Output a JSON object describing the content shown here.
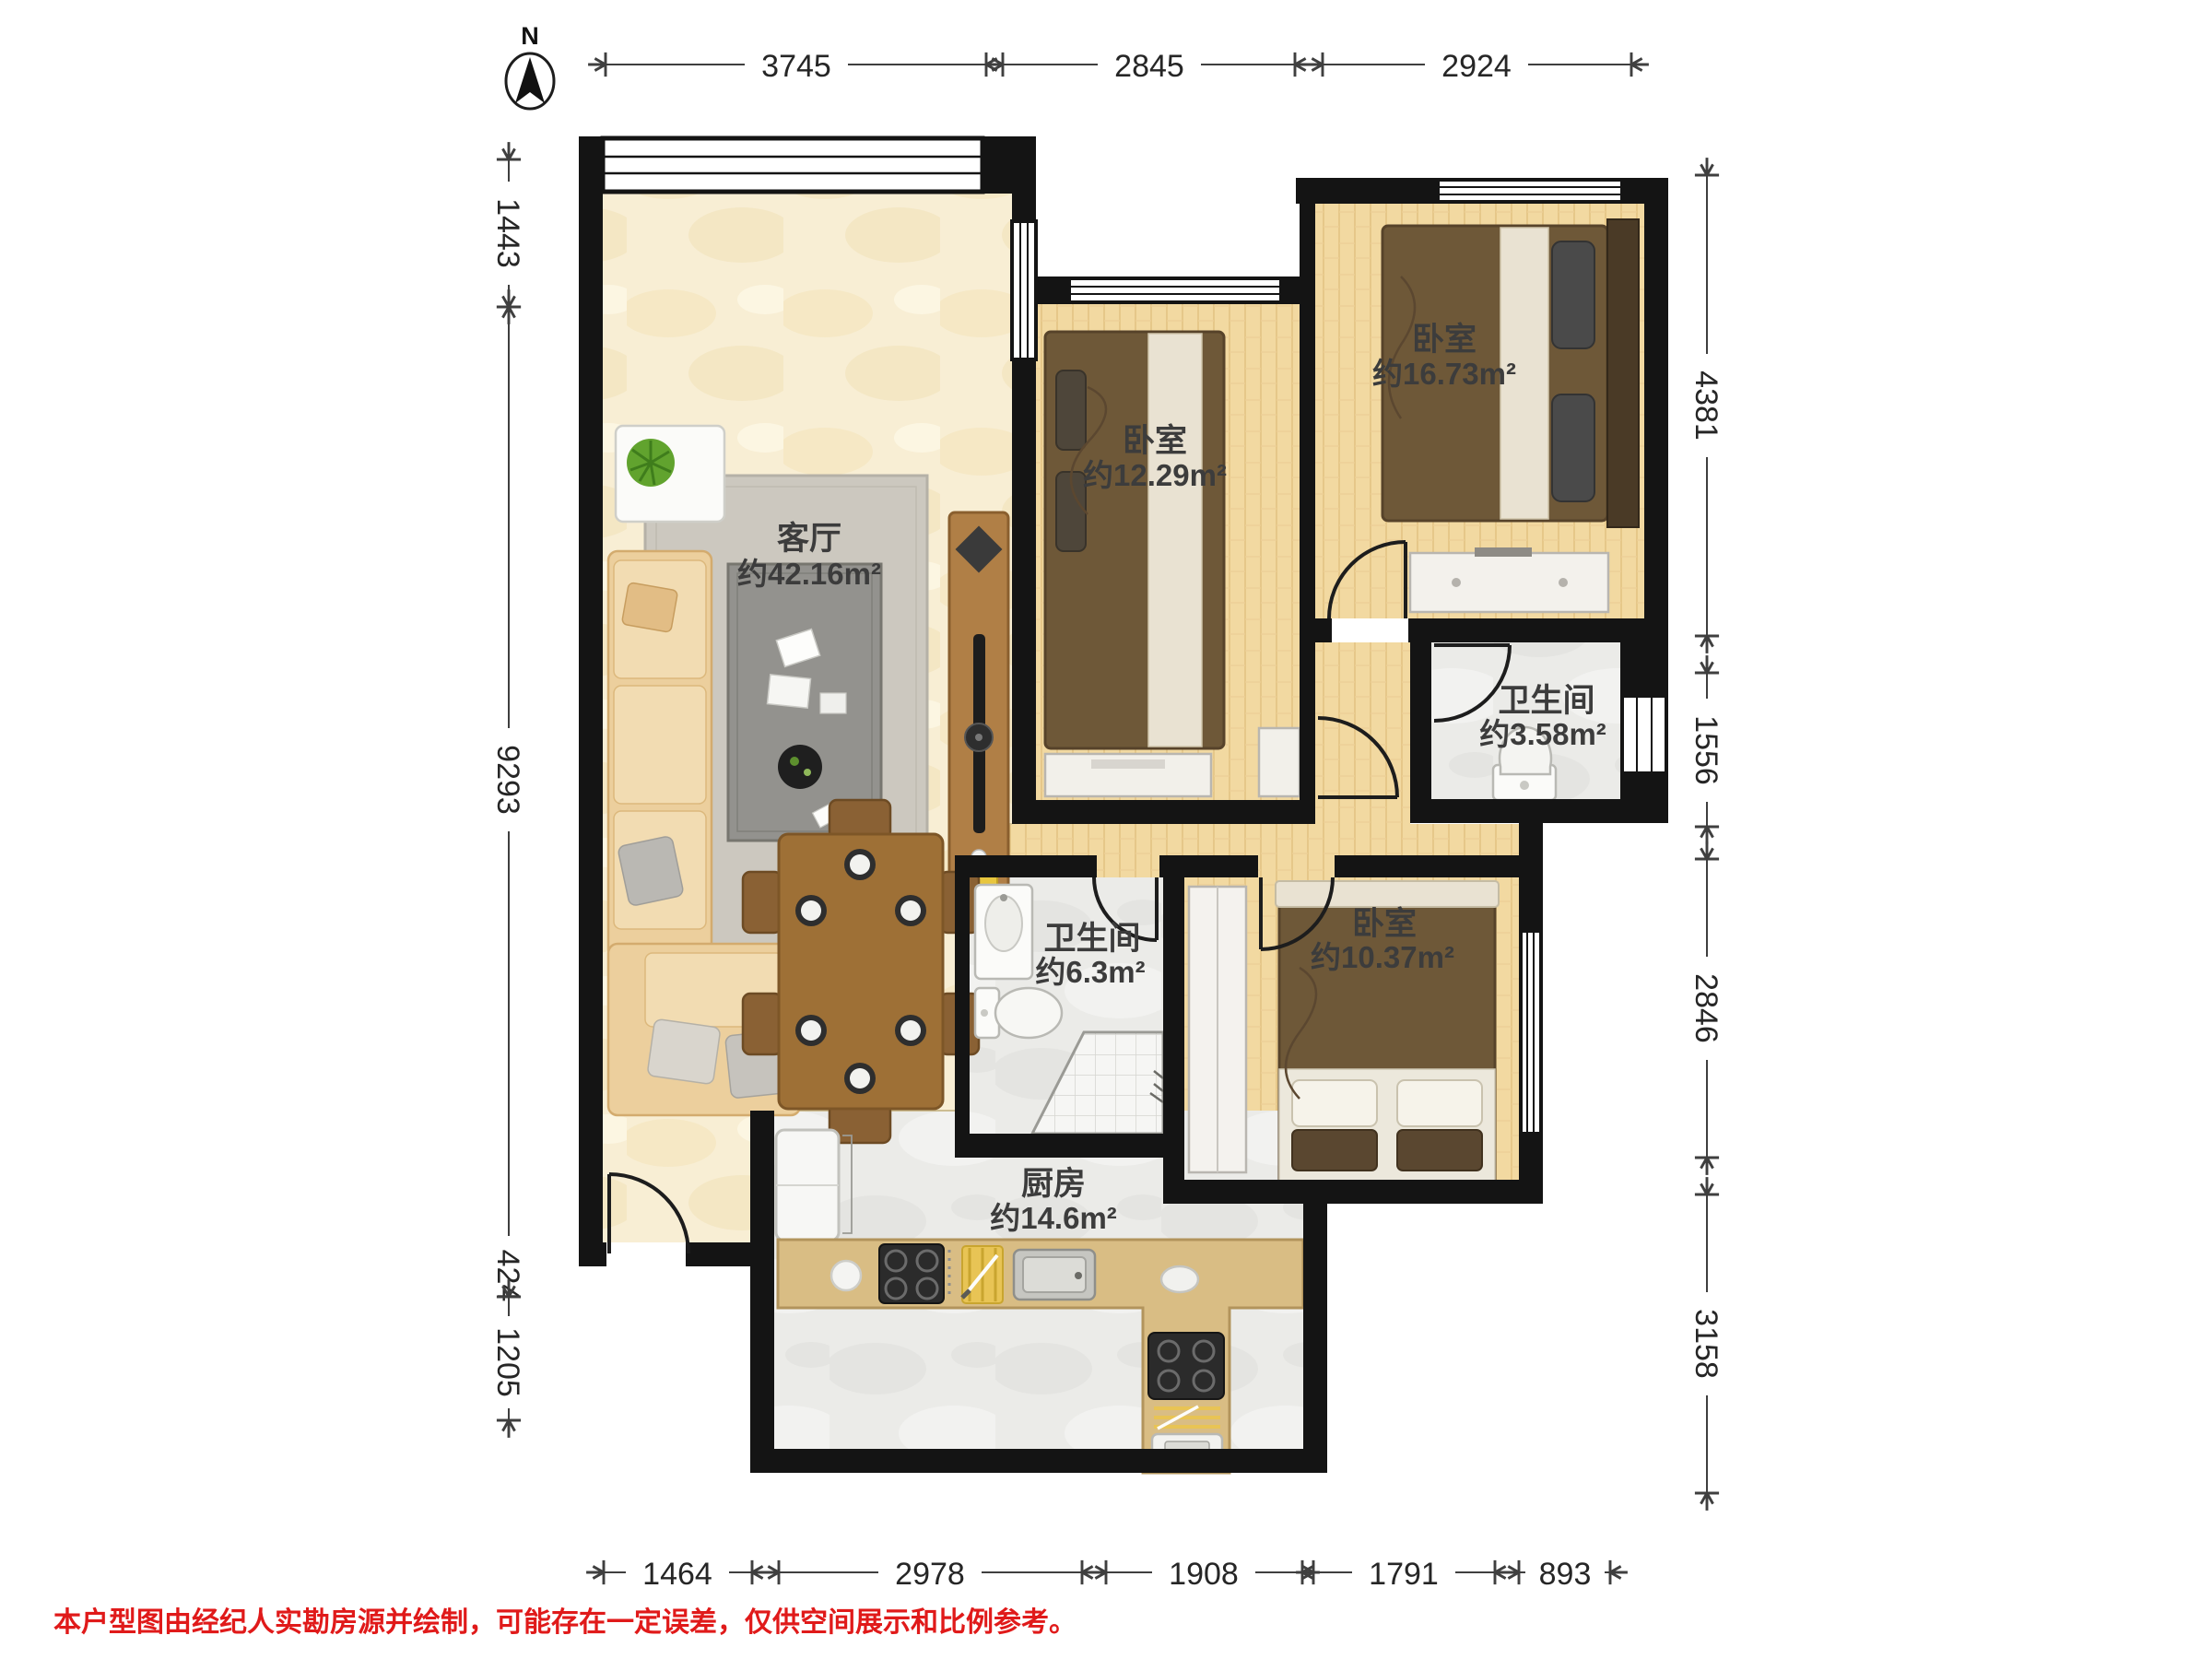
{
  "compass": {
    "label": "N"
  },
  "rooms": {
    "living": {
      "name": "客厅",
      "area": "约42.16m²"
    },
    "bedroom_mid": {
      "name": "卧室",
      "area": "约12.29m²"
    },
    "bedroom_top_right": {
      "name": "卧室",
      "area": "约16.73m²"
    },
    "bathroom_small": {
      "name": "卫生间",
      "area": "约3.58m²"
    },
    "bathroom_large": {
      "name": "卫生间",
      "area": "约6.3m²"
    },
    "bedroom_right": {
      "name": "卧室",
      "area": "约10.37m²"
    },
    "kitchen": {
      "name": "厨房",
      "area": "约14.6m²"
    }
  },
  "dimensions_mm": {
    "top": [
      "3745",
      "2845",
      "2924"
    ],
    "bottom": [
      "1464",
      "2978",
      "1908",
      "1791",
      "893"
    ],
    "left": [
      "1443",
      "9293",
      "424",
      "1205"
    ],
    "right": [
      "4381",
      "1556",
      "2846",
      "3158"
    ]
  },
  "disclaimer": "本户型图由经纪人实勘房源并绘制，可能存在一定误差，仅供空间展示和比例参考。",
  "colors": {
    "wall": "#141414",
    "wood_floor": "#f2d9a1",
    "stone_floor": "#ebebe8",
    "beige_floor": "#f8eed4",
    "counter": "#d9bd84",
    "bed": "#6e5838",
    "disclaimer_red": "#e01a1a"
  }
}
